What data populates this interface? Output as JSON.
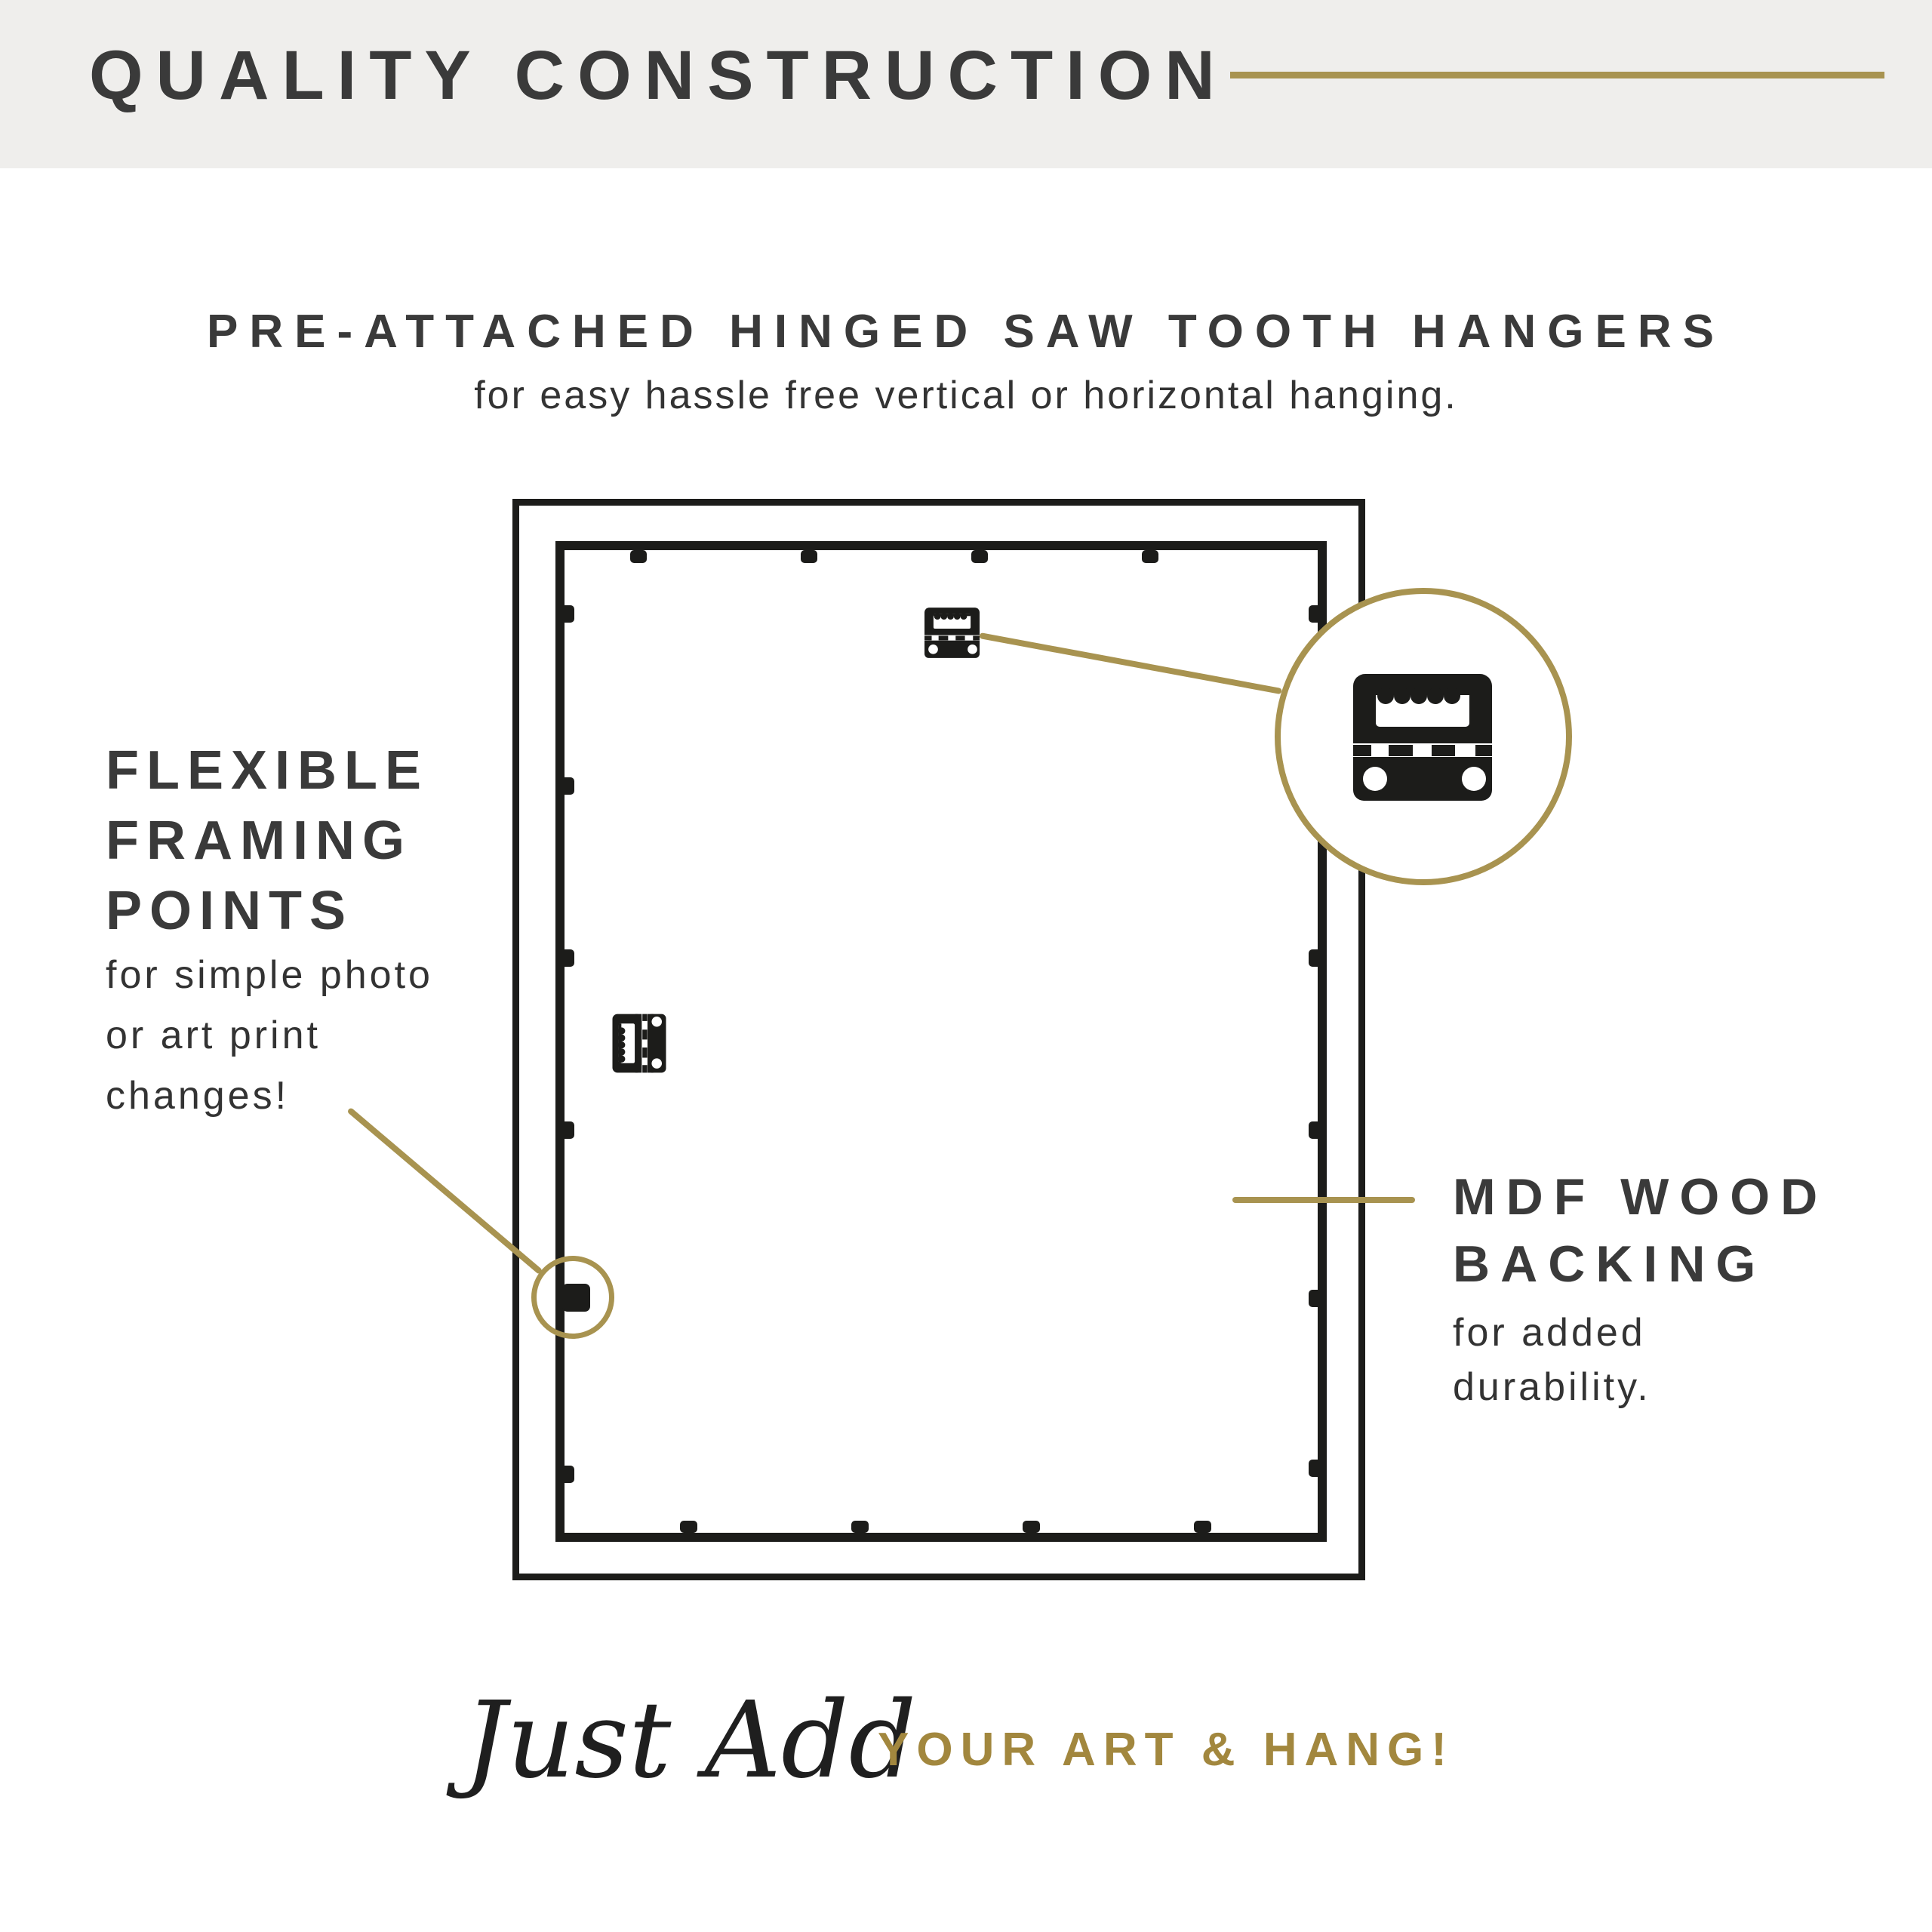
{
  "header": {
    "title": "QUALITY CONSTRUCTION"
  },
  "hero": {
    "title": "PRE-ATTACHED HINGED SAW TOOTH HANGERS",
    "subtitle": "for easy hassle free vertical or horizontal hanging."
  },
  "callouts": {
    "flexible_framing_points": {
      "title_lines": [
        "FLEXIBLE",
        "FRAMING",
        "POINTS"
      ],
      "body_lines": [
        "for simple photo",
        "or art print",
        "changes!"
      ]
    },
    "mdf_wood_backing": {
      "title_lines": [
        "MDF WOOD",
        "BACKING"
      ],
      "body_lines": [
        "for added",
        "durability."
      ]
    }
  },
  "footer": {
    "script_text": "Just Add",
    "cta_text": "YOUR ART & HANG!"
  },
  "icons": {
    "large_zoomed_icon": "sawtooth-hanger-icon",
    "top_of_frame_icon": "sawtooth-hanger-icon",
    "side_of_frame_icon": "hinged-sawtooth-hanger-icon"
  },
  "colors": {
    "gold": "#a89350",
    "gold_text": "#a2873e",
    "ink": "#1c1c1a",
    "heading": "#3a3a3a",
    "body_text": "#333333",
    "band_bg": "#efeeec",
    "page_bg": "#ffffff"
  }
}
